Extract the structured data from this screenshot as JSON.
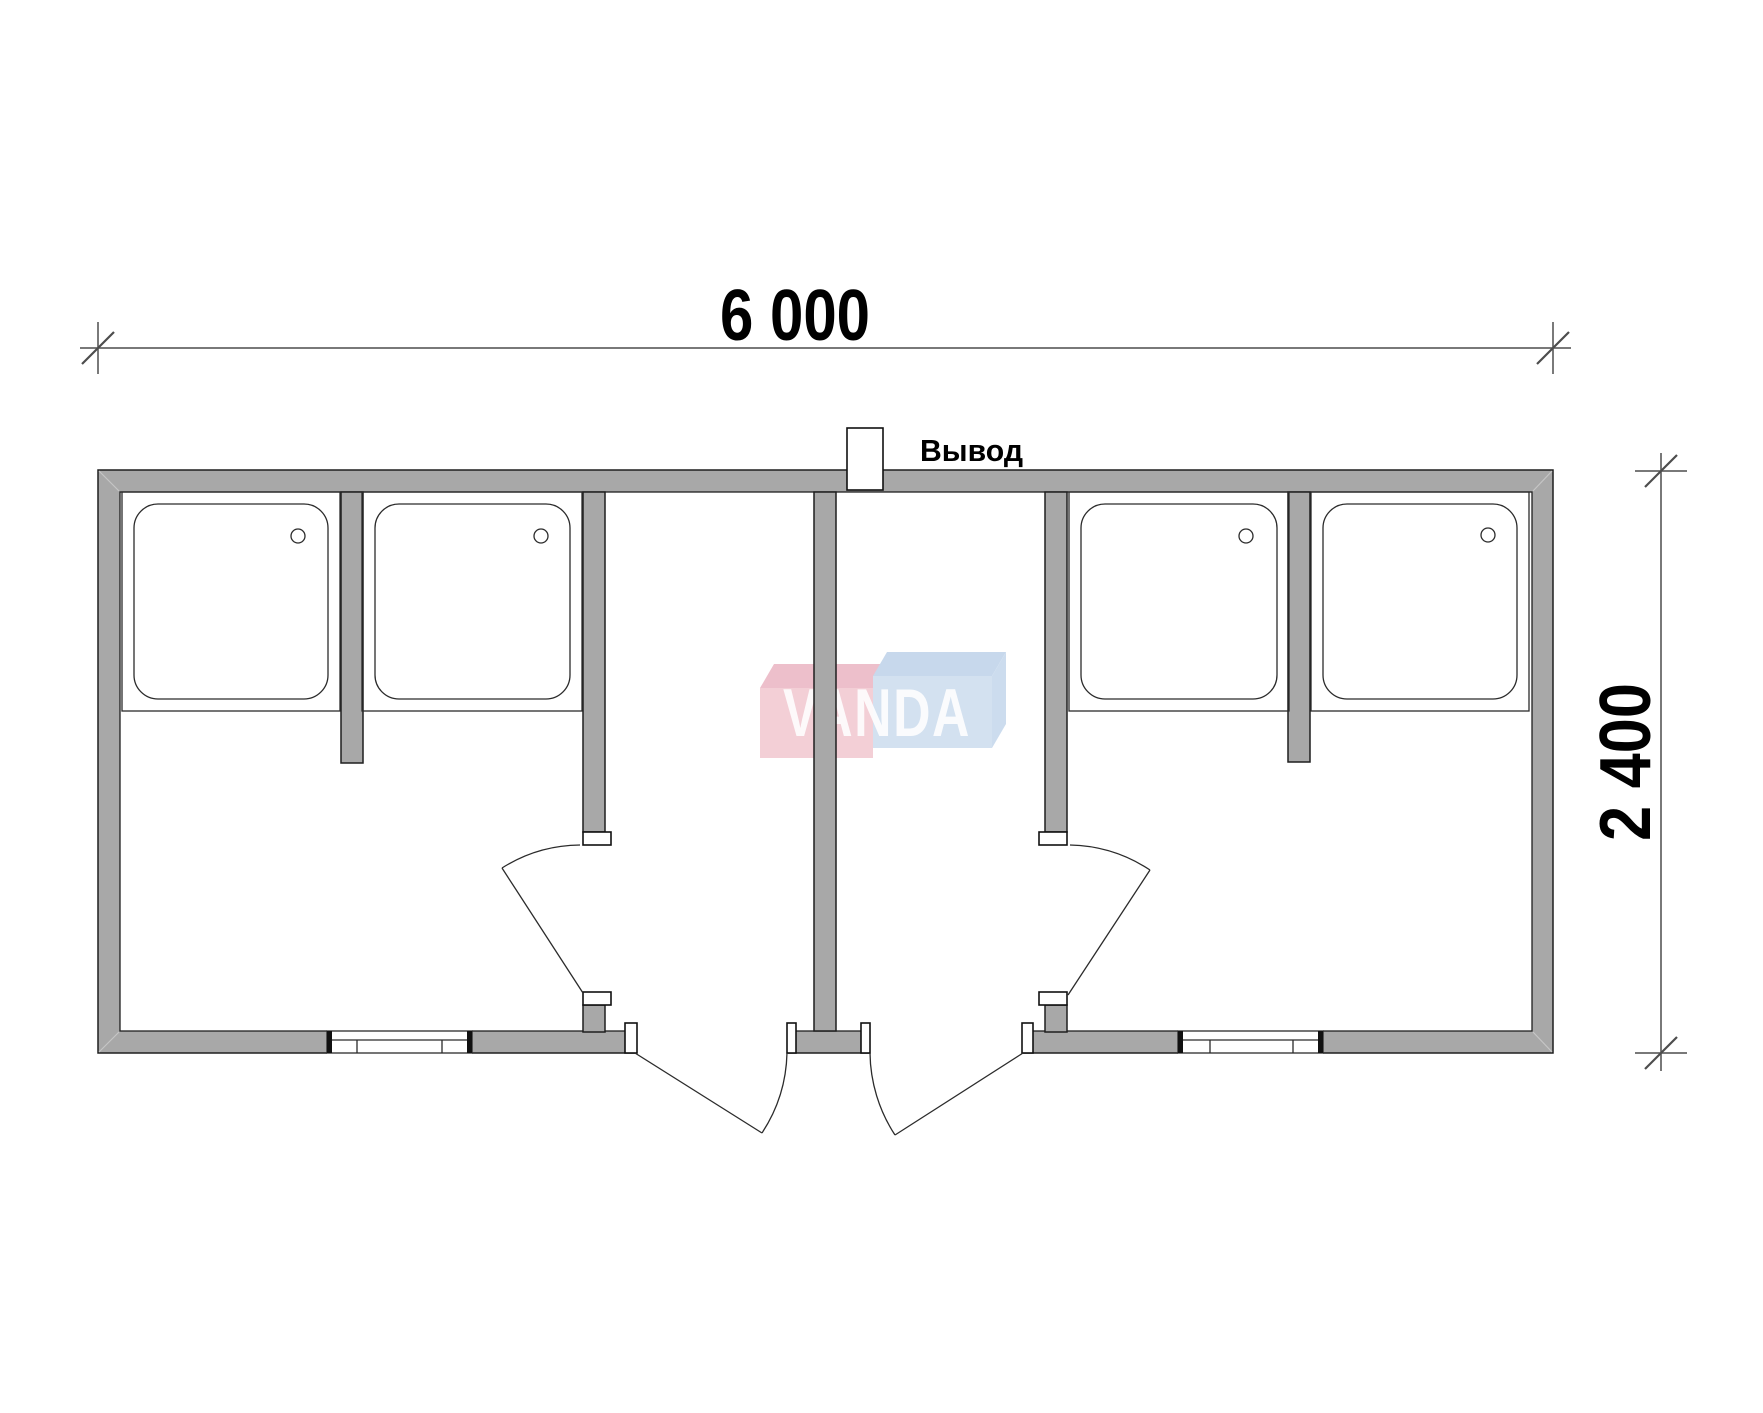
{
  "drawing": {
    "dimension_width_label": "6 000",
    "dimension_height_label": "2 400",
    "outlet_label": "Вывод",
    "watermark_text": "VANDA",
    "colors": {
      "wall_fill": "#a8a8a8",
      "plan_line": "#2b2b2b",
      "dimension_line": "#4d4d4d",
      "text": "#000000",
      "watermark_pink": "#f1c7d0",
      "watermark_pink_top": "#eab5c2",
      "watermark_blue": "#ccdcee",
      "watermark_blue_top": "#bed2e9",
      "watermark_letters": "#ffffff"
    },
    "fixtures": {
      "shower_trays": 4,
      "doors": 4,
      "windows": 2,
      "outlets": 1
    }
  }
}
